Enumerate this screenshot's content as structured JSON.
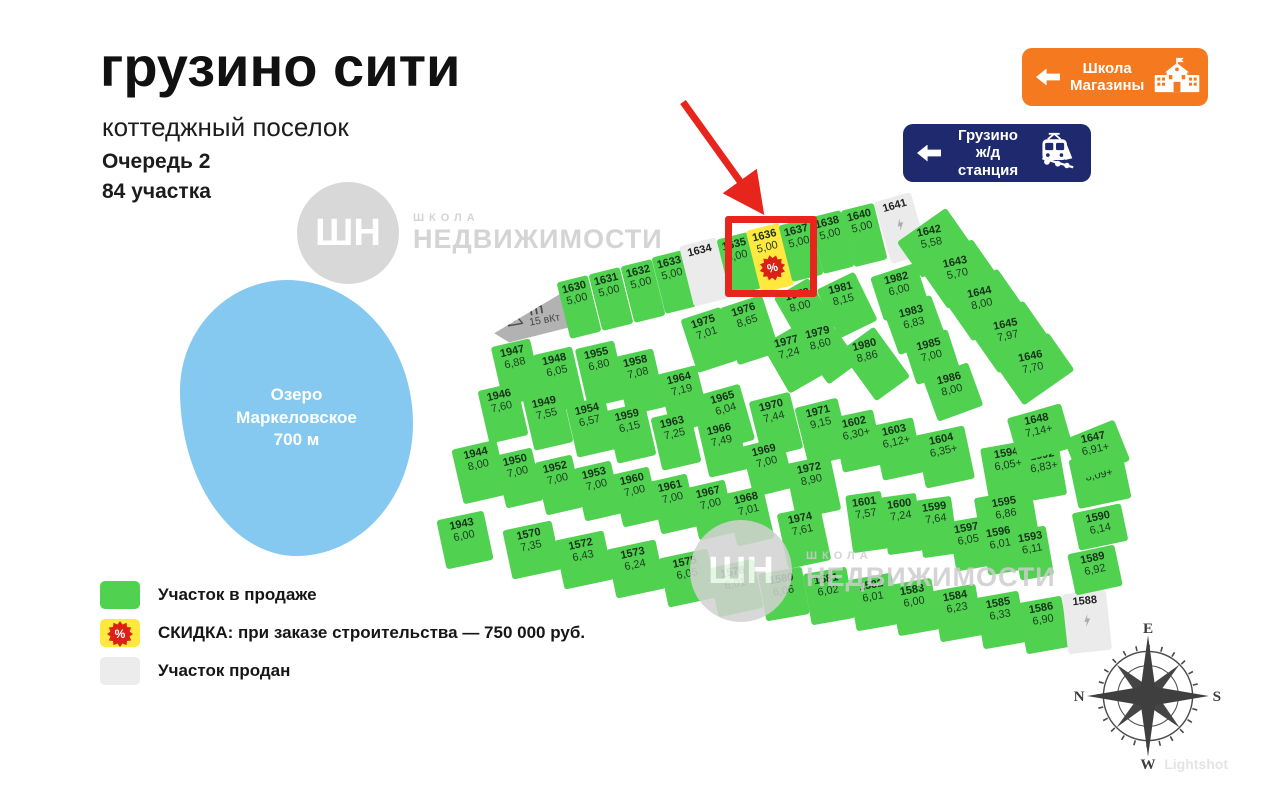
{
  "header": {
    "title": "грузино сити",
    "subtitle": "коттеджный поселок",
    "queue": "Очередь 2",
    "count": "84 участка"
  },
  "badges": {
    "school": {
      "line1": "Школа",
      "line2": "Магазины"
    },
    "station": {
      "line1": "Грузино",
      "line2": "ж/д станция"
    }
  },
  "lake": {
    "line1": "Озеро",
    "line2": "Маркеловское",
    "line3": "700 м"
  },
  "tp": {
    "title": "ТП",
    "subtitle": "15 вКт"
  },
  "legend": {
    "sale": "Участок в продаже",
    "discount_bold": "СКИДКА:",
    "discount_rest": " при заказе строительства — 750 000 руб.",
    "sold": "Участок продан",
    "discount_icon": "%"
  },
  "watermark": {
    "monogram": "ШН",
    "small": "ШКОЛА",
    "big": "НЕДВИЖИМОСТИ"
  },
  "compass": {
    "top": "E",
    "right": "S",
    "bottom": "W",
    "left": "N"
  },
  "footer": {
    "lightshot": "Lightshot"
  },
  "colors": {
    "plot_sale": "#50d250",
    "plot_discount": "#ffe93e",
    "plot_sold": "#ebebeb",
    "highlight_red": "#e8251d",
    "lake_blue": "#85c9f0",
    "school_badge_orange": "#f4791f",
    "station_badge_navy": "#1f2a6e"
  },
  "plots": [
    {
      "id": "1630",
      "area": "5,00",
      "s": "sale",
      "x": 579,
      "y": 307,
      "w": 32,
      "h": 58,
      "r": -14
    },
    {
      "id": "1631",
      "area": "5,00",
      "s": "sale",
      "x": 611,
      "y": 299,
      "w": 32,
      "h": 58,
      "r": -14
    },
    {
      "id": "1632",
      "area": "5,00",
      "s": "sale",
      "x": 643,
      "y": 291,
      "w": 32,
      "h": 58,
      "r": -14
    },
    {
      "id": "1633",
      "area": "5,00",
      "s": "sale",
      "x": 674,
      "y": 282,
      "w": 32,
      "h": 58,
      "r": -14
    },
    {
      "id": "1634",
      "area": "",
      "s": "sold",
      "x": 705,
      "y": 272,
      "w": 38,
      "h": 62,
      "r": -14
    },
    {
      "id": "1635",
      "area": "5,00",
      "s": "sale",
      "x": 739,
      "y": 264,
      "w": 32,
      "h": 58,
      "r": -14
    },
    {
      "id": "1636",
      "area": "5,00",
      "s": "discount",
      "x": 770,
      "y": 258,
      "w": 34,
      "h": 64,
      "r": -14
    },
    {
      "id": "1637",
      "area": "5,00",
      "s": "sale",
      "x": 801,
      "y": 250,
      "w": 32,
      "h": 58,
      "r": -14
    },
    {
      "id": "1638",
      "area": "5,00",
      "s": "sale",
      "x": 832,
      "y": 242,
      "w": 32,
      "h": 58,
      "r": -14
    },
    {
      "id": "1640",
      "area": "5,00",
      "s": "sale",
      "x": 864,
      "y": 235,
      "w": 34,
      "h": 58,
      "r": -14
    },
    {
      "id": "1641",
      "area": "",
      "s": "sold",
      "icon": "bolt",
      "x": 901,
      "y": 228,
      "w": 38,
      "h": 64,
      "r": -16
    },
    {
      "id": "1642",
      "area": "5,58",
      "s": "sale",
      "x": 934,
      "y": 243,
      "w": 60,
      "h": 44,
      "r": -35,
      "lr": -12
    },
    {
      "id": "1643",
      "area": "5,70",
      "s": "sale",
      "x": 960,
      "y": 274,
      "w": 60,
      "h": 44,
      "r": -35,
      "lr": -12
    },
    {
      "id": "1644",
      "area": "8,00",
      "s": "sale",
      "x": 985,
      "y": 305,
      "w": 62,
      "h": 46,
      "r": -35,
      "lr": -12
    },
    {
      "id": "1645",
      "area": "7,97",
      "s": "sale",
      "x": 1011,
      "y": 337,
      "w": 62,
      "h": 46,
      "r": -35,
      "lr": -12
    },
    {
      "id": "1646",
      "area": "7,70",
      "s": "sale",
      "x": 1036,
      "y": 369,
      "w": 62,
      "h": 46,
      "r": -35,
      "lr": -12
    },
    {
      "id": "1975",
      "area": "7,01",
      "s": "sale",
      "x": 709,
      "y": 340,
      "w": 42,
      "h": 56,
      "r": -18
    },
    {
      "id": "1976",
      "area": "8,65",
      "s": "sale",
      "x": 750,
      "y": 330,
      "w": 44,
      "h": 60,
      "r": -18
    },
    {
      "id": "1978",
      "area": "8,00",
      "s": "sale",
      "x": 805,
      "y": 312,
      "w": 40,
      "h": 56,
      "r": -30,
      "lr": -14
    },
    {
      "id": "1977",
      "area": "7,24",
      "s": "sale",
      "x": 794,
      "y": 359,
      "w": 42,
      "h": 56,
      "r": -30,
      "lr": -14
    },
    {
      "id": "1979",
      "area": "8,60",
      "s": "sale",
      "x": 827,
      "y": 350,
      "w": 38,
      "h": 58,
      "r": -36,
      "lr": -14
    },
    {
      "id": "1980",
      "area": "8,86",
      "s": "sale",
      "x": 875,
      "y": 364,
      "w": 42,
      "h": 62,
      "r": -36,
      "lr": -14
    },
    {
      "id": "1981",
      "area": "8,15",
      "s": "sale",
      "x": 847,
      "y": 305,
      "w": 42,
      "h": 54,
      "r": -26,
      "lr": -14
    },
    {
      "id": "1982",
      "area": "6,00",
      "s": "sale",
      "x": 900,
      "y": 292,
      "w": 48,
      "h": 46,
      "r": -18,
      "lr": -14
    },
    {
      "id": "1983",
      "area": "6,83",
      "s": "sale",
      "x": 915,
      "y": 325,
      "w": 50,
      "h": 46,
      "r": -20,
      "lr": -14
    },
    {
      "id": "1985",
      "area": "7,00",
      "s": "sale",
      "x": 932,
      "y": 357,
      "w": 46,
      "h": 44,
      "r": -18,
      "lr": -14
    },
    {
      "id": "1986",
      "area": "8,00",
      "s": "sale",
      "x": 953,
      "y": 392,
      "w": 48,
      "h": 46,
      "r": -20,
      "lr": -14
    },
    {
      "id": "1947",
      "area": "6,88",
      "s": "sale",
      "x": 517,
      "y": 372,
      "w": 40,
      "h": 60,
      "r": -13
    },
    {
      "id": "1948",
      "area": "6,05",
      "s": "sale",
      "x": 559,
      "y": 380,
      "w": 40,
      "h": 60,
      "r": -13
    },
    {
      "id": "1955",
      "area": "6,80",
      "s": "sale",
      "x": 601,
      "y": 374,
      "w": 40,
      "h": 60,
      "r": -13
    },
    {
      "id": "1958",
      "area": "7,08",
      "s": "sale",
      "x": 640,
      "y": 382,
      "w": 40,
      "h": 60,
      "r": -13
    },
    {
      "id": "1964",
      "area": "7,19",
      "s": "sale",
      "x": 684,
      "y": 399,
      "w": 40,
      "h": 60,
      "r": -14
    },
    {
      "id": "1965",
      "area": "6,04",
      "s": "sale",
      "x": 728,
      "y": 417,
      "w": 40,
      "h": 58,
      "r": -16
    },
    {
      "id": "1970",
      "area": "7,44",
      "s": "sale",
      "x": 776,
      "y": 425,
      "w": 42,
      "h": 58,
      "r": -14
    },
    {
      "id": "1971",
      "area": "9,15",
      "s": "sale",
      "x": 823,
      "y": 432,
      "w": 44,
      "h": 60,
      "r": -14
    },
    {
      "id": "1602",
      "area": "6,30+",
      "s": "sale",
      "x": 858,
      "y": 441,
      "w": 42,
      "h": 56,
      "r": -12
    },
    {
      "id": "1603",
      "area": "6,12+",
      "s": "sale",
      "x": 898,
      "y": 449,
      "w": 42,
      "h": 56,
      "r": -12
    },
    {
      "id": "1604",
      "area": "6,35+",
      "s": "sale",
      "x": 945,
      "y": 457,
      "w": 50,
      "h": 54,
      "r": -12
    },
    {
      "id": "1946",
      "area": "7,60",
      "s": "sale",
      "x": 503,
      "y": 413,
      "w": 40,
      "h": 54,
      "r": -13
    },
    {
      "id": "1949",
      "area": "7,55",
      "s": "sale",
      "x": 548,
      "y": 420,
      "w": 40,
      "h": 54,
      "r": -13
    },
    {
      "id": "1954",
      "area": "6,57",
      "s": "sale",
      "x": 591,
      "y": 427,
      "w": 40,
      "h": 54,
      "r": -13
    },
    {
      "id": "1959",
      "area": "6,15",
      "s": "sale",
      "x": 631,
      "y": 433,
      "w": 40,
      "h": 54,
      "r": -13
    },
    {
      "id": "1963",
      "area": "7,25",
      "s": "sale",
      "x": 676,
      "y": 440,
      "w": 40,
      "h": 54,
      "r": -13
    },
    {
      "id": "1966",
      "area": "7,49",
      "s": "sale",
      "x": 723,
      "y": 447,
      "w": 40,
      "h": 54,
      "r": -13
    },
    {
      "id": "1969",
      "area": "7,00",
      "s": "sale",
      "x": 768,
      "y": 467,
      "w": 42,
      "h": 52,
      "r": -14
    },
    {
      "id": "1972",
      "area": "8,90",
      "s": "sale",
      "x": 813,
      "y": 487,
      "w": 46,
      "h": 56,
      "r": -12
    },
    {
      "id": "1944",
      "area": "8,00",
      "s": "sale",
      "x": 480,
      "y": 472,
      "w": 46,
      "h": 56,
      "r": -13
    },
    {
      "id": "1950",
      "area": "7,00",
      "s": "sale",
      "x": 519,
      "y": 478,
      "w": 38,
      "h": 54,
      "r": -13
    },
    {
      "id": "1952",
      "area": "7,00",
      "s": "sale",
      "x": 559,
      "y": 485,
      "w": 38,
      "h": 54,
      "r": -13
    },
    {
      "id": "1953",
      "area": "7,00",
      "s": "sale",
      "x": 598,
      "y": 491,
      "w": 38,
      "h": 54,
      "r": -13
    },
    {
      "id": "1960",
      "area": "7,00",
      "s": "sale",
      "x": 636,
      "y": 497,
      "w": 38,
      "h": 54,
      "r": -13
    },
    {
      "id": "1961",
      "area": "7,00",
      "s": "sale",
      "x": 674,
      "y": 504,
      "w": 38,
      "h": 54,
      "r": -13
    },
    {
      "id": "1967",
      "area": "7,00",
      "s": "sale",
      "x": 712,
      "y": 510,
      "w": 38,
      "h": 54,
      "r": -13
    },
    {
      "id": "1968",
      "area": "7,01",
      "s": "sale",
      "x": 750,
      "y": 516,
      "w": 38,
      "h": 54,
      "r": -13
    },
    {
      "id": "1974",
      "area": "7,61",
      "s": "sale",
      "x": 804,
      "y": 537,
      "w": 44,
      "h": 56,
      "r": -12
    },
    {
      "id": "1943",
      "area": "6,00",
      "s": "sale",
      "x": 465,
      "y": 540,
      "w": 48,
      "h": 50,
      "r": -12
    },
    {
      "id": "1570",
      "area": "7,35",
      "s": "sale",
      "x": 532,
      "y": 550,
      "w": 50,
      "h": 50,
      "r": -12
    },
    {
      "id": "1572",
      "area": "6,43",
      "s": "sale",
      "x": 584,
      "y": 560,
      "w": 50,
      "h": 50,
      "r": -12
    },
    {
      "id": "1573",
      "area": "6,24",
      "s": "sale",
      "x": 636,
      "y": 569,
      "w": 50,
      "h": 50,
      "r": -12
    },
    {
      "id": "1575",
      "area": "6,05",
      "s": "sale",
      "x": 688,
      "y": 578,
      "w": 50,
      "h": 50,
      "r": -12
    },
    {
      "id": "1578",
      "area": "6,01",
      "s": "sale",
      "x": 736,
      "y": 588,
      "w": 46,
      "h": 50,
      "r": -12
    },
    {
      "id": "1580",
      "area": "6,06",
      "s": "sale",
      "x": 784,
      "y": 594,
      "w": 44,
      "h": 48,
      "r": -10
    },
    {
      "id": "1581",
      "area": "6,02",
      "s": "sale",
      "x": 829,
      "y": 596,
      "w": 44,
      "h": 52,
      "r": -10
    },
    {
      "id": "1582",
      "area": "6,01",
      "s": "sale",
      "x": 874,
      "y": 602,
      "w": 44,
      "h": 52,
      "r": -10
    },
    {
      "id": "1583",
      "area": "6,00",
      "s": "sale",
      "x": 915,
      "y": 607,
      "w": 42,
      "h": 52,
      "r": -10
    },
    {
      "id": "1584",
      "area": "6,23",
      "s": "sale",
      "x": 958,
      "y": 613,
      "w": 44,
      "h": 52,
      "r": -10
    },
    {
      "id": "1585",
      "area": "6,33",
      "s": "sale",
      "x": 1001,
      "y": 620,
      "w": 44,
      "h": 52,
      "r": -10
    },
    {
      "id": "1586",
      "area": "6,90",
      "s": "sale",
      "x": 1044,
      "y": 625,
      "w": 44,
      "h": 52,
      "r": -10
    },
    {
      "id": "1588",
      "area": "",
      "s": "sold",
      "icon": "bolt",
      "x": 1087,
      "y": 622,
      "w": 44,
      "h": 60,
      "r": -6
    },
    {
      "id": "1601",
      "area": "7,57",
      "s": "sale",
      "x": 867,
      "y": 522,
      "w": 36,
      "h": 58,
      "r": -8
    },
    {
      "id": "1600",
      "area": "7,24",
      "s": "sale",
      "x": 902,
      "y": 524,
      "w": 36,
      "h": 58,
      "r": -8
    },
    {
      "id": "1599",
      "area": "7,64",
      "s": "sale",
      "x": 937,
      "y": 527,
      "w": 36,
      "h": 58,
      "r": -8
    },
    {
      "id": "1595",
      "area": "6,86",
      "s": "sale",
      "x": 1006,
      "y": 514,
      "w": 58,
      "h": 42,
      "r": -10
    },
    {
      "id": "1597",
      "area": "6,05",
      "s": "sale",
      "x": 969,
      "y": 544,
      "w": 34,
      "h": 50,
      "r": -10
    },
    {
      "id": "1596",
      "area": "6,01",
      "s": "sale",
      "x": 1001,
      "y": 548,
      "w": 34,
      "h": 50,
      "r": -10
    },
    {
      "id": "1593",
      "area": "6,11",
      "s": "sale",
      "x": 1033,
      "y": 553,
      "w": 34,
      "h": 50,
      "r": -10
    },
    {
      "id": "1594",
      "area": "6,05+",
      "s": "sale",
      "x": 1009,
      "y": 469,
      "w": 50,
      "h": 50,
      "r": -10
    },
    {
      "id": "1592",
      "area": "6,83+",
      "s": "sale",
      "x": 1045,
      "y": 472,
      "w": 36,
      "h": 52,
      "r": -10
    },
    {
      "id": "1591",
      "area": "8,09+",
      "s": "sale",
      "x": 1100,
      "y": 479,
      "w": 54,
      "h": 50,
      "r": -12
    },
    {
      "id": "1590",
      "area": "6,14",
      "s": "sale",
      "x": 1100,
      "y": 527,
      "w": 50,
      "h": 38,
      "r": -12
    },
    {
      "id": "1589",
      "area": "6,92",
      "s": "sale",
      "x": 1095,
      "y": 570,
      "w": 48,
      "h": 42,
      "r": -12
    },
    {
      "id": "1648",
      "area": "7,14+",
      "s": "sale",
      "x": 1040,
      "y": 433,
      "w": 56,
      "h": 46,
      "r": -16,
      "lr": -12
    },
    {
      "id": "1647",
      "area": "6,91+",
      "s": "sale",
      "x": 1097,
      "y": 450,
      "w": 54,
      "h": 44,
      "r": -22,
      "lr": -12
    }
  ]
}
